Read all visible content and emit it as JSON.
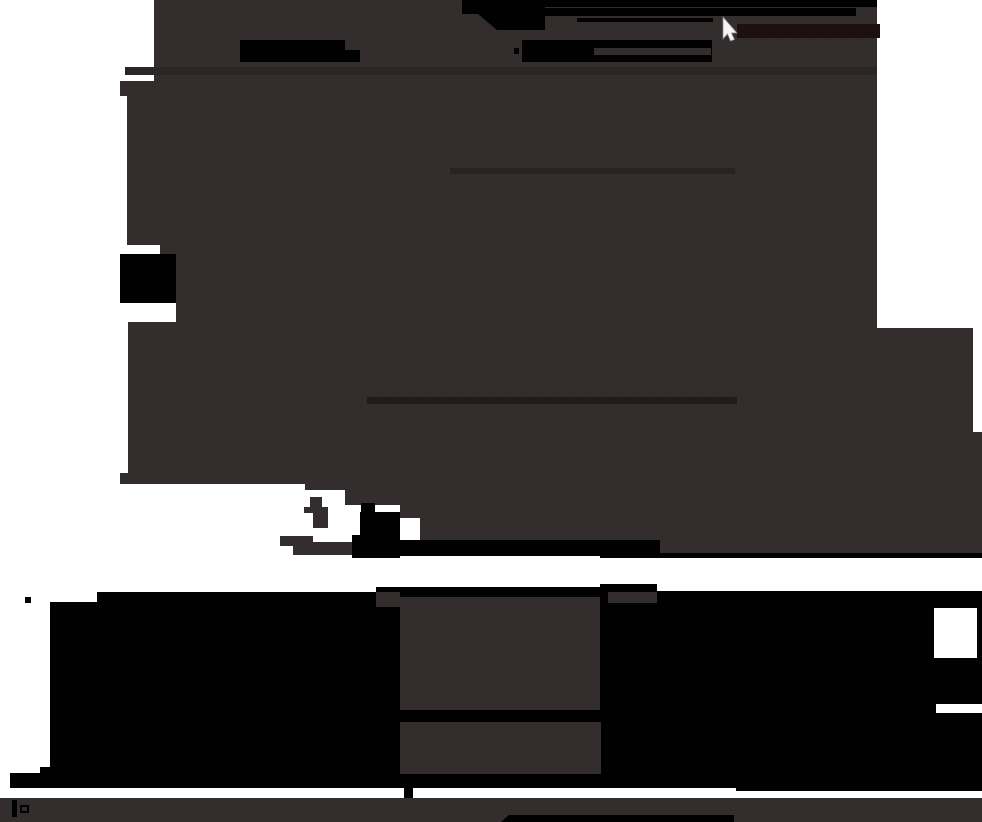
{
  "scene": {
    "kind": "posterized-silhouette-photo",
    "description": "High-contrast thresholded scene: large dark foliage-like mass over white background, black streaks, banded dark hedge strip at bottom, gray ground bar, white mouse pointer near top",
    "canvas": {
      "width": 982,
      "height": 822
    }
  },
  "palette": {
    "white": "#ffffff",
    "gray_mass": "#332d2d",
    "black": "#020101",
    "maroon_bar": "#1c1010",
    "faint_band": "#2b2626",
    "streak_mid": "#272323",
    "streak_low": "#201c1c",
    "speckle": "#262121",
    "cursor_fill": "#f5f5f5",
    "cursor_edge": "#8a8a8a"
  },
  "cursor": {
    "x": 723,
    "y": 17,
    "visible": true
  }
}
